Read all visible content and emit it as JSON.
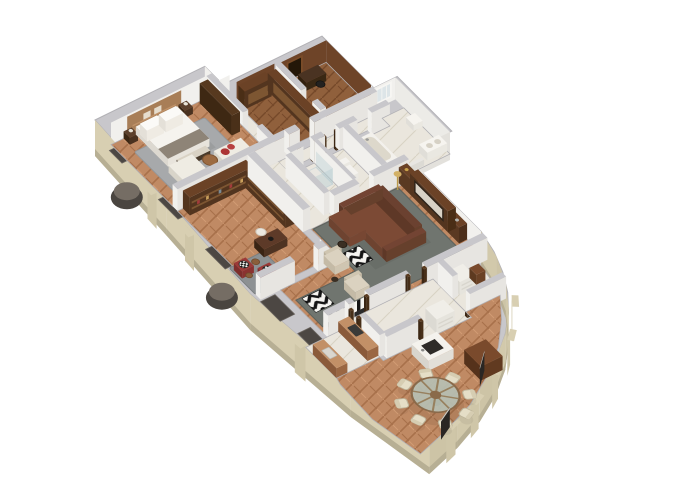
{
  "meta": {
    "type": "3d-floor-plan-render",
    "description": "Isometric 3D cutaway floor plan of a luxury apartment rendered on a white background",
    "background": "#ffffff"
  },
  "palette": {
    "wallTop": "#c8c7cb",
    "wallEdge": "#b2b1b5",
    "wallFaceSouth": "#e7e5e1",
    "wallFaceWest": "#f1f0ed",
    "innerWhite": "#f1f0ed",
    "facade": "#d8cfb2",
    "facadeShade": "#cdc4a6",
    "facadeDark": "#b7af94",
    "windowRecess": "#4c4743",
    "recessFrame": "#6a645e",
    "balconyDark": "#4a4540",
    "balconyTop": "#756d64",
    "woodFloor": "#c08a64",
    "woodFloorLine": "#a8714b",
    "woodFloorLight": "#d29c74",
    "woodDarkFloor": "#90603c",
    "woodDarkLine": "#76492a",
    "marble": "#eae6dd",
    "marbleLine": "#d8d2c3",
    "panelWood": "#6e4428",
    "furnDarkWood": "#53351f",
    "furnDarkWoodTop": "#6b4226",
    "furnMidWood": "#7a4a2c",
    "furnWarmWood": "#9c6b42",
    "counterWood": "#a9744c",
    "counterWoodTop": "#c29067",
    "sofaBrown": "#7c4a35",
    "sofaBrownDark": "#6b4130",
    "cream": "#dbd2c0",
    "creamDark": "#cfc5b0",
    "whiteFurn": "#f2f0ea",
    "bedWhite": "#f5f3ee",
    "throwGray": "#8e8477",
    "rugGray": "#a7a9ab",
    "rugGreen": "#70756f",
    "rugSmall": "#8d9193",
    "accentRed": "#ac3535",
    "chairRed": "#9c3a38",
    "blackish": "#1e1c1a",
    "chevronDark": "#141414",
    "chevronLight": "#f5f4f0",
    "glassTable": "#b7c0b4",
    "chairCream": "#e5dec7",
    "tvScreen": "#d8d2c6",
    "headboard": "#a87e57",
    "glassShower": "rgba(175,200,205,0.35)",
    "gold": "#c9a34c"
  },
  "rooms": [
    {
      "id": "master-bedroom",
      "label": "Master Bedroom"
    },
    {
      "id": "vestibule",
      "label": "Vestibule"
    },
    {
      "id": "walk-in-closet",
      "label": "Walk-in Closet"
    },
    {
      "id": "study",
      "label": "Study"
    },
    {
      "id": "corridor",
      "label": "Corridor"
    },
    {
      "id": "shower-room",
      "label": "Shower Room"
    },
    {
      "id": "wc",
      "label": "WC"
    },
    {
      "id": "bathroom",
      "label": "Bathroom"
    },
    {
      "id": "library",
      "label": "Library / Home Office"
    },
    {
      "id": "living-room",
      "label": "Living Room"
    },
    {
      "id": "hallway",
      "label": "Hallway"
    },
    {
      "id": "kitchen",
      "label": "Kitchen"
    },
    {
      "id": "pantry",
      "label": "Pantry"
    },
    {
      "id": "dining-room",
      "label": "Dining Room"
    }
  ],
  "furniture": {
    "master-bedroom": [
      "double-bed",
      "headboard-wall",
      "nightstands",
      "bed-bench",
      "sofa",
      "chaise-lounge",
      "round-coffee-table",
      "wardrobe",
      "area-rug"
    ],
    "walk-in-closet": [
      "wardrobe-run",
      "wardrobe-run"
    ],
    "study": [
      "desk",
      "desk-chair",
      "wood-paneling"
    ],
    "bathroom": [
      "bathtub",
      "double-vanity",
      "toilet",
      "window"
    ],
    "shower-room": [
      "walk-in-shower"
    ],
    "wc": [
      "toilet"
    ],
    "library": [
      "corner-bookshelves",
      "writing-desk",
      "desk-chair",
      "red-armchairs",
      "side-tables",
      "area-rug"
    ],
    "living-room": [
      "media-wall-tv",
      "leather-sofa",
      "cream-armchairs",
      "chevron-ottoman",
      "chevron-rug",
      "striped-bench",
      "area-rug",
      "floor-lamp",
      "side-table"
    ],
    "kitchen": [
      "counter-run",
      "counter-run",
      "cooktop",
      "sink"
    ],
    "dining-room": [
      "round-glass-table",
      "dining-chairs-x8",
      "kitchen-island",
      "wood-cabinet",
      "white-shelf",
      "curved-window-wall"
    ]
  },
  "exterior": [
    "stone-facade",
    "recessed-windows",
    "round-balcony",
    "round-balcony",
    "facade-piers",
    "curved-bay"
  ]
}
